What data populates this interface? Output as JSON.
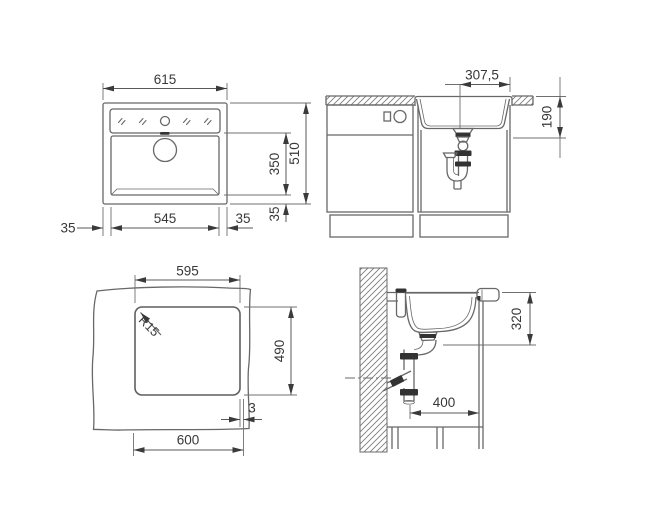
{
  "drawing": {
    "plan": {
      "width_top": "615",
      "height_right": "510",
      "inner_depth": "350",
      "margin_bottom_right_v": "35",
      "margin_left": "35",
      "inner_width": "545",
      "margin_right": "35"
    },
    "front_section": {
      "drain_offset": "307,5",
      "bowl_depth": "190"
    },
    "cutout": {
      "cutout_width": "595",
      "corner_radius": "R15",
      "cutout_depth": "490",
      "base_width": "600",
      "edge_gap": "3"
    },
    "side_section": {
      "install_depth": "320",
      "wall_clearance": "400"
    }
  },
  "colors": {
    "background": "#ffffff",
    "line": "#707070",
    "text": "#383838",
    "fitting_dark": "#333333"
  }
}
